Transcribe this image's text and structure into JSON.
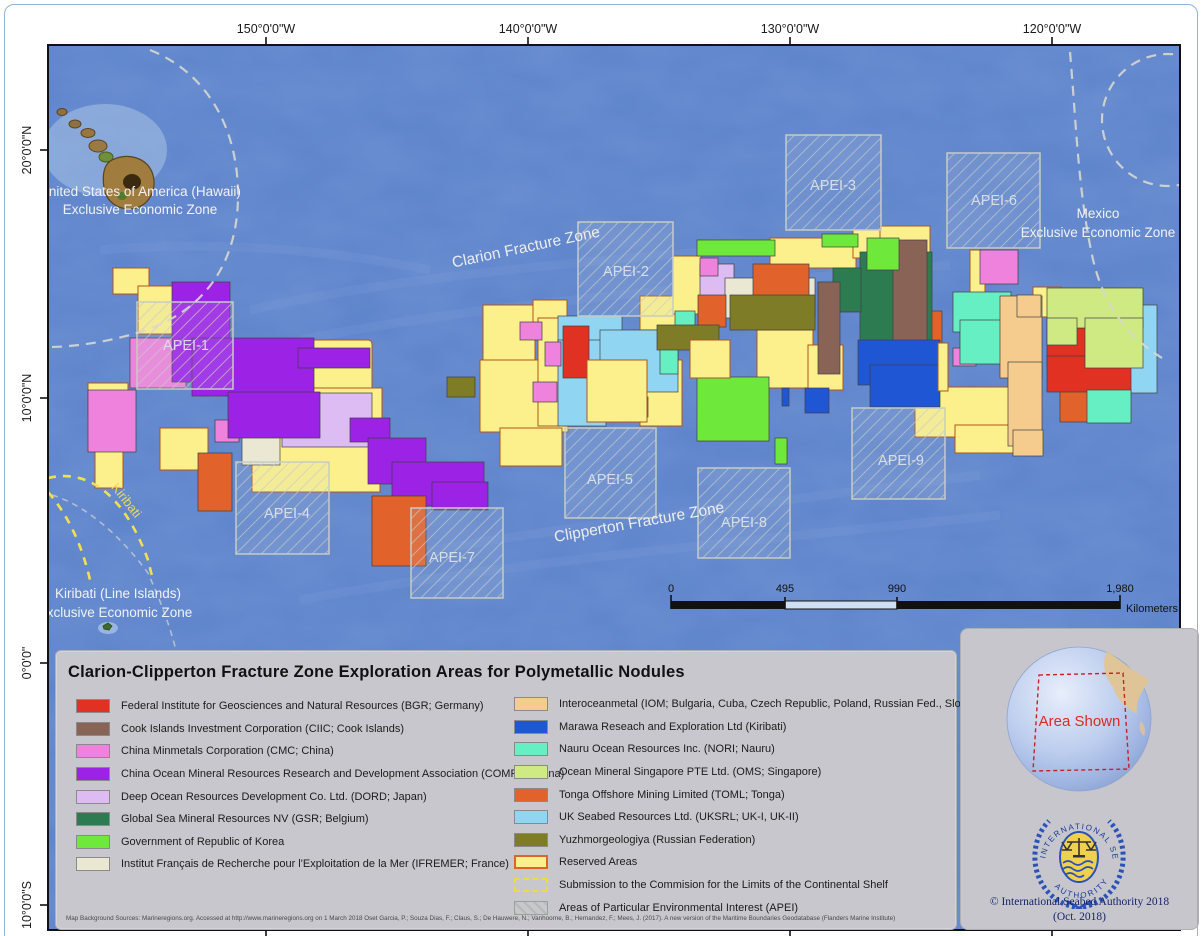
{
  "axes": {
    "top": [
      "150°0'0\"W",
      "140°0'0\"W",
      "130°0'0\"W",
      "120°0'0\"W"
    ],
    "left": [
      "20°0'0\"N",
      "10°0'0\"N",
      "0°0'0\"",
      "10°0'0\"S"
    ]
  },
  "map_labels": {
    "us_eez_line1": "United States of America (Hawaii)",
    "us_eez_line2": "Exclusive Economic Zone",
    "mexico_line1": "Mexico",
    "mexico_line2": "Exclusive Economic Zone",
    "kiribati_eez_line1": "Kiribati (Line Islands)",
    "kiribati_eez_line2": "Exclusive Economic Zone",
    "kiribati": "Kiribati",
    "clarion": "Clarion Fracture Zone",
    "clipperton": "Clipperton Fracture Zone",
    "apei": [
      "APEI-1",
      "APEI-2",
      "APEI-3",
      "APEI-4",
      "APEI-5",
      "APEI-6",
      "APEI-7",
      "APEI-8",
      "APEI-9"
    ]
  },
  "scalebar": {
    "ticks": [
      "0",
      "495",
      "990",
      "1,980"
    ],
    "unit": "Kilometers"
  },
  "legend": {
    "title": "Clarion-Clipperton Fracture Zone Exploration Areas for Polymetallic Nodules",
    "left": [
      {
        "label": "Federal Institute for Geosciences and Natural Resources (BGR; Germany)",
        "color": "#E03122"
      },
      {
        "label": "Cook Islands Investment Corporation (CIIC; Cook Islands)",
        "color": "#8A6357"
      },
      {
        "label": "China Minmetals Corporation (CMC; China)",
        "color": "#EE82DC"
      },
      {
        "label": "China Ocean Mineral Resources Research and Development Association (COMRA; China)",
        "color": "#9C22E6"
      },
      {
        "label": "Deep Ocean Resources Development Co. Ltd. (DORD; Japan)",
        "color": "#DCBCF2"
      },
      {
        "label": "Global Sea Mineral Resources NV (GSR; Belgium)",
        "color": "#2D7B51"
      },
      {
        "label": "Government of Republic of Korea",
        "color": "#6EE83B"
      },
      {
        "label": "Institut Français de Recherche pour l'Exploitation de la Mer (IFREMER; France)",
        "color": "#EAE8D2"
      }
    ],
    "right": [
      {
        "label": "Interoceanmetal (IOM; Bulgaria, Cuba, Czech Republic, Poland, Russian Fed., Slovakia)",
        "color": "#F5CB8E"
      },
      {
        "label": "Marawa Reseach and Exploration Ltd (Kiribati)",
        "color": "#1F56D4"
      },
      {
        "label": "Nauru Ocean Resources Inc. (NORI; Nauru)",
        "color": "#67EFC4"
      },
      {
        "label": "Ocean Mineral Singapore PTE Ltd. (OMS; Singapore)",
        "color": "#CFEA82"
      },
      {
        "label": "Tonga Offshore Mining Limited (TOML; Tonga)",
        "color": "#E2622B"
      },
      {
        "label": "UK Seabed Resources Ltd. (UKSRL; UK-I, UK-II)",
        "color": "#90D6F2"
      },
      {
        "label": "Yuzhmorgeologiya (Russian Federation)",
        "color": "#7E7C26"
      },
      {
        "label": "Reserved Areas",
        "type": "reserved"
      },
      {
        "label": "Submission to the Commision for the Limits of the Continental Shelf",
        "type": "submission"
      },
      {
        "label": "Areas of Particular Environmental Interest (APEI)",
        "type": "apei"
      }
    ]
  },
  "sources": "Map Background Sources: Marineregions.org. Accessed at http://www.marineregions.org on 1 March 2018 Oset Garcia, P.; Souza Dias, F.; Claus, S.; De Hauwere, N.; Vanhoorne, B.; Hernandez, F.; Mees, J. (2017). A new version of the Maritime Boundaries Geodatabase (Flanders Marine Institute)",
  "info": {
    "area_shown": "Area Shown",
    "logo_top_text": "INTERNATIONAL SEABED",
    "logo_bottom_text": "AUTHORITY",
    "copyright_line1": "© International Seabed Authority 2018",
    "copyright_line2": "(Oct. 2018)"
  },
  "colors": {
    "ocean": "#5D83CB",
    "reserved_area": "#FBF08C",
    "eez_dash": "#D9D9CF",
    "clcs_dash": "#F2E14A"
  }
}
